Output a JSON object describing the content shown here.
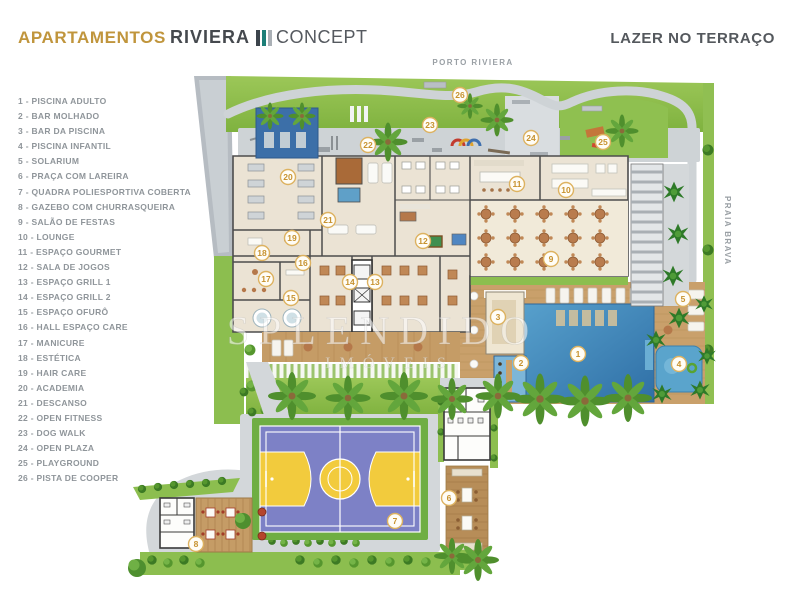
{
  "header": {
    "apartamentos": "APARTAMENTOS",
    "logo_name": "RIVIERA",
    "logo_suffix": "CONCEPT",
    "title": "LAZER NO TERRAÇO"
  },
  "plan": {
    "top_label": "PORTO RIVIERA",
    "right_label": "PRAIA BRAVA",
    "watermark_line1": "SPLENDIDO",
    "watermark_line2": "IMÓVEIS"
  },
  "colors": {
    "accent_gold": "#C0953C",
    "logo_teal": "#1D7F78",
    "marker_gold": "#C7922F",
    "grass_green": "#8CBE4F",
    "pool_blue": "#3F7FB5",
    "court_purple": "#7D81C6",
    "court_yellow": "#F2CB3D",
    "deck_wood": "#C59C66"
  },
  "features": [
    {
      "num": "1",
      "label": "PISCINA ADULTO",
      "x": 578,
      "y": 354
    },
    {
      "num": "2",
      "label": "BAR MOLHADO",
      "x": 521,
      "y": 363
    },
    {
      "num": "3",
      "label": "BAR DA PISCINA",
      "x": 498,
      "y": 317
    },
    {
      "num": "4",
      "label": "PISCINA INFANTIL",
      "x": 679,
      "y": 364
    },
    {
      "num": "5",
      "label": "SOLARIUM",
      "x": 683,
      "y": 299
    },
    {
      "num": "6",
      "label": "PRAÇA COM LAREIRA",
      "x": 449,
      "y": 498
    },
    {
      "num": "7",
      "label": "QUADRA POLIESPORTIVA COBERTA",
      "x": 395,
      "y": 521
    },
    {
      "num": "8",
      "label": "GAZEBO COM CHURRASQUEIRA",
      "x": 196,
      "y": 544
    },
    {
      "num": "9",
      "label": "SALÃO DE FESTAS",
      "x": 551,
      "y": 259
    },
    {
      "num": "10",
      "label": "LOUNGE",
      "x": 566,
      "y": 190
    },
    {
      "num": "11",
      "label": "ESPAÇO GOURMET",
      "x": 517,
      "y": 184
    },
    {
      "num": "12",
      "label": "SALA DE JOGOS",
      "x": 423,
      "y": 241
    },
    {
      "num": "13",
      "label": "ESPAÇO GRILL 1",
      "x": 375,
      "y": 282
    },
    {
      "num": "14",
      "label": "ESPAÇO GRILL 2",
      "x": 350,
      "y": 282
    },
    {
      "num": "15",
      "label": "ESPAÇO OFURÔ",
      "x": 291,
      "y": 298
    },
    {
      "num": "16",
      "label": "HALL ESPAÇO CARE",
      "x": 303,
      "y": 263
    },
    {
      "num": "17",
      "label": "MANICURE",
      "x": 266,
      "y": 279
    },
    {
      "num": "18",
      "label": "ESTÉTICA",
      "x": 262,
      "y": 253
    },
    {
      "num": "19",
      "label": "HAIR CARE",
      "x": 292,
      "y": 238
    },
    {
      "num": "20",
      "label": "ACADEMIA",
      "x": 288,
      "y": 177
    },
    {
      "num": "21",
      "label": "DESCANSO",
      "x": 328,
      "y": 220
    },
    {
      "num": "22",
      "label": "OPEN FITNESS",
      "x": 368,
      "y": 145
    },
    {
      "num": "23",
      "label": "DOG WALK",
      "x": 430,
      "y": 125
    },
    {
      "num": "24",
      "label": "OPEN PLAZA",
      "x": 531,
      "y": 138
    },
    {
      "num": "25",
      "label": "PLAYGROUND",
      "x": 603,
      "y": 142
    },
    {
      "num": "26",
      "label": "PISTA DE COOPER",
      "x": 460,
      "y": 95
    }
  ]
}
